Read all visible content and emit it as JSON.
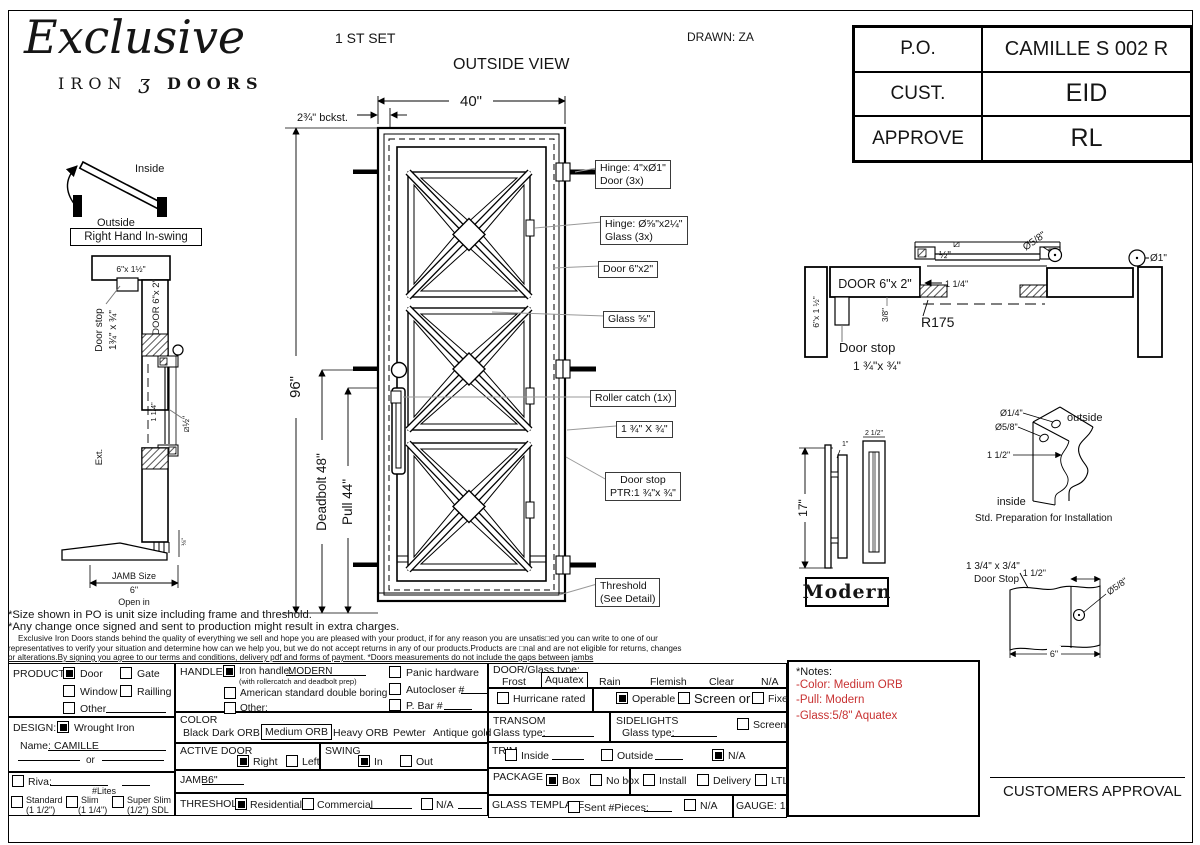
{
  "header": {
    "logo_title": "Exclusive",
    "logo_iron": "IRON",
    "logo_orn": "ʒ",
    "logo_doors": "DOORS",
    "set_label": "1 ST SET",
    "view_label": "OUTSIDE VIEW",
    "drawn_label": "DRAWN: ZA",
    "info_rows": [
      {
        "label": "P.O.",
        "value": "CAMILLE S 002 R"
      },
      {
        "label": "CUST.",
        "value": "EID"
      },
      {
        "label": "APPROVE",
        "value": "RL"
      }
    ]
  },
  "swing": {
    "inside": "Inside",
    "outside": "Outside",
    "caption": "Right Hand In-swing"
  },
  "left_section": {
    "jamb_dim": "6\"x 1½\"",
    "door_stop_1": "Door stop",
    "door_stop_2": "1¾\" x ¾\"",
    "door_dim": "DOOR 6\"x 2\"",
    "gap_dim": "1 1/4\"",
    "glass_dim": "⧄½\"",
    "ext": "Ext.",
    "jamb_1": "JAMB Size",
    "jamb_2": "6\"",
    "jamb_3": "Open in"
  },
  "elevation": {
    "width_dim": "40\"",
    "backset_dim": "2¾\" bckst.",
    "height_dim": "96\"",
    "deadbolt_dim": "Deadbolt 48\"",
    "pull_dim": "Pull 44\"",
    "co_hinge_door_1": "Hinge: 4\"xØ1\"",
    "co_hinge_door_2": "Door (3x)",
    "co_hinge_glass_1": "Hinge: Ø⅝\"x2¼\"",
    "co_hinge_glass_2": "Glass (3x)",
    "co_door": "Door 6\"x2\"",
    "co_glass": "Glass ⅝\"",
    "co_roller": "Roller catch  (1x)",
    "co_stop_dim": "1 ¾\" X ¾\"",
    "co_stop_1": "Door stop",
    "co_stop_2": "PTR:1 ¾\"x ¾\"",
    "co_threshold_1": "Threshold",
    "co_threshold_2": "(See Detail)"
  },
  "head_section": {
    "door_dim": "DOOR 6\"x 2\"",
    "jamb_dim": "6\"x 1 ½\"",
    "square_sym": "⧄",
    "half_dim": "½\"",
    "dia_58": "Ø5/8\"",
    "dia_1": "Ø1\"",
    "dim_114": "1 1/4\"",
    "dim_38": "3/8\"",
    "radius": "R175",
    "stop_1": "Door stop",
    "stop_2": "1 ¾\"x ¾\""
  },
  "handle_detail": {
    "dim_17": "17\"",
    "dim_1": "1\"",
    "dim_25": "2 1/2\"",
    "caption": "Modern"
  },
  "std_prep": {
    "dia_14": "Ø1/4\"",
    "dia_58": "Ø5/8\"",
    "dim_112": "1 1/2\"",
    "outside": "outside",
    "inside": "inside",
    "caption": "Std. Preparation for Installation"
  },
  "stop_detail": {
    "label_1": "1 3/4\" x 3/4\"",
    "label_2": "Door Stop",
    "dim_112": "1 1/2\"",
    "dia_58": "Ø5/8\"",
    "dim_6": "6\""
  },
  "disclaimer": {
    "line1": "*Size shown in PO is unit size including frame and threshold.",
    "line2": "*Any change once signed and sent to production might result in extra charges.",
    "line3": "Exclusive Iron Doors stands behind the quality of everything we sell and hope you are pleased with your product, if for any reason you are unsatis□ed you can write to one of our",
    "line4": "representatives to verify your situation and determine how can we help you, but we do not accept returns in any of our products.Products are □nal and are not eligible for returns, changes",
    "line5": "or alterations.By signing you agree to our terms and conditions, delivery pdf and forms of payment. *Doors measurements do not include the gaps between jambs"
  },
  "form": {
    "product": {
      "label": "PRODUCT:",
      "door": "Door",
      "gate": "Gate",
      "window": "Window",
      "railling": "Railling",
      "other": "Other"
    },
    "design": {
      "label": "DESIGN:",
      "wrought": "Wrought Iron",
      "name_label": "Name:",
      "name_value": "CAMILLE",
      "or_label": "or"
    },
    "riva": {
      "label": "Riva:",
      "lites": "#Lites",
      "standard": "Standard",
      "standard_sub": "(1 1/2\")",
      "slim": "Slim",
      "slim_sub": "(1 1/4\")",
      "superslim": "Super Slim",
      "superslim_sub": "(1/2\") SDL"
    },
    "handle": {
      "label": "HANDLE",
      "iron": "Iron handle:",
      "iron_value": "MODERN",
      "iron_sub": "(with rollercatch and deadbolt prep)",
      "american": "American standard double boring",
      "other": "Other:",
      "panic": "Panic hardware",
      "autocloser": "Autocloser #",
      "pbar": "P. Bar #"
    },
    "color": {
      "label": "COLOR",
      "black": "Black",
      "dark": "Dark ORB",
      "medium": "Medium ORB",
      "heavy": "Heavy ORB",
      "pewter": "Pewter",
      "antique": "Antique gold"
    },
    "active": {
      "label": "ACTIVE DOOR",
      "right": "Right",
      "left": "Left"
    },
    "swing": {
      "label": "SWING",
      "in_opt": "In",
      "out_opt": "Out"
    },
    "jamb": {
      "label": "JAMB:",
      "value": "6\""
    },
    "threshold": {
      "label": "THRESHOLD",
      "residential": "Residential",
      "commercial": "Commercial",
      "na": "N/A"
    },
    "doorglass": {
      "label": "DOOR/Glass type:",
      "frost": "Frost",
      "aquatex": "Aquatex",
      "rain": "Rain",
      "flemish": "Flemish",
      "clear": "Clear",
      "na": "N/A"
    },
    "hurricane": {
      "label": "Hurricane rated"
    },
    "operable": {
      "operable": "Operable",
      "screen_or": "Screen or",
      "fixed": "Fixed"
    },
    "transom": {
      "label": "TRANSOM",
      "glass": "Glass type:"
    },
    "sidelights": {
      "label": "SIDELIGHTS",
      "glass": "Glass type:",
      "screen": "Screen"
    },
    "trim": {
      "label": "TRIM",
      "inside": "Inside",
      "outside": "Outside",
      "na": "N/A"
    },
    "pkg": {
      "label": "PACKAGE",
      "box": "Box",
      "nobox": "No box",
      "install": "Install",
      "delivery": "Delivery",
      "ltl": "LTL"
    },
    "template": {
      "label": "GLASS TEMPLATE",
      "sent": "Sent #Pieces:",
      "na": "N/A"
    },
    "gauge": {
      "label": "GAUGE: 14"
    }
  },
  "notes_box": {
    "title": "*Notes:",
    "line1": "-Color: Medium ORB",
    "line2": "-Pull: Modern",
    "line3": "-Glass:5/8\"  Aquatex",
    "color": "#c83232"
  },
  "approval": {
    "label": "CUSTOMERS APPROVAL"
  }
}
